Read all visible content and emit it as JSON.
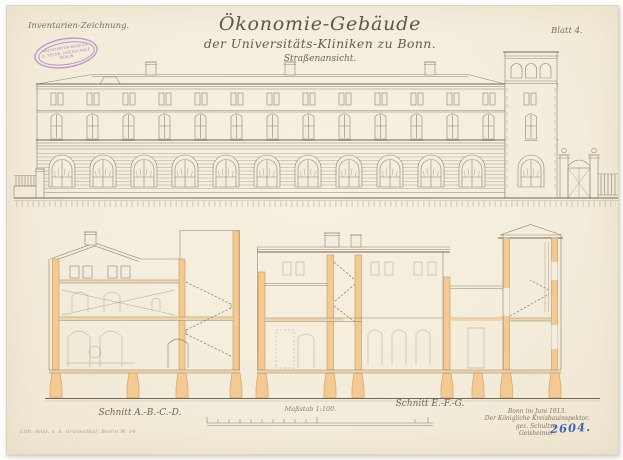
{
  "page": {
    "paper_color": "#f4eddc",
    "ink_color": "#6b6355",
    "section_fill_color": "#f4c992",
    "stamp_color": "#9a6fb8",
    "pencil_blue": "#4465b3"
  },
  "header": {
    "classification": "Inventarien-Zeichnung.",
    "sheet_label": "Blatt 4."
  },
  "stamp": {
    "line1": "ARCHITEKTUR-MUSEUM",
    "line2": "D. TECHN. HOCHSCHULE",
    "line3": "BERLIN"
  },
  "title": {
    "main": "Ökonomie-Gebäude",
    "sub": "der Universitäts-Kliniken zu Bonn.",
    "view": "Straßenansicht."
  },
  "labels": {
    "section_left": "Schnitt A.-B.-C.-D.",
    "scale": "Maßstab 1:100.",
    "section_right": "Schnitt E.-F.-G."
  },
  "signature": {
    "line1": "Bonn im Juni 1913.",
    "line2": "Der Königliche Kreisbauinspektor.",
    "line3": "gez. Schultze.",
    "line4": "Geisheimer.",
    "inventory_number": "2604."
  },
  "footer": {
    "printer_note": "Lith. Anst. v. A. Grunenthal, Berlin W. 14."
  }
}
